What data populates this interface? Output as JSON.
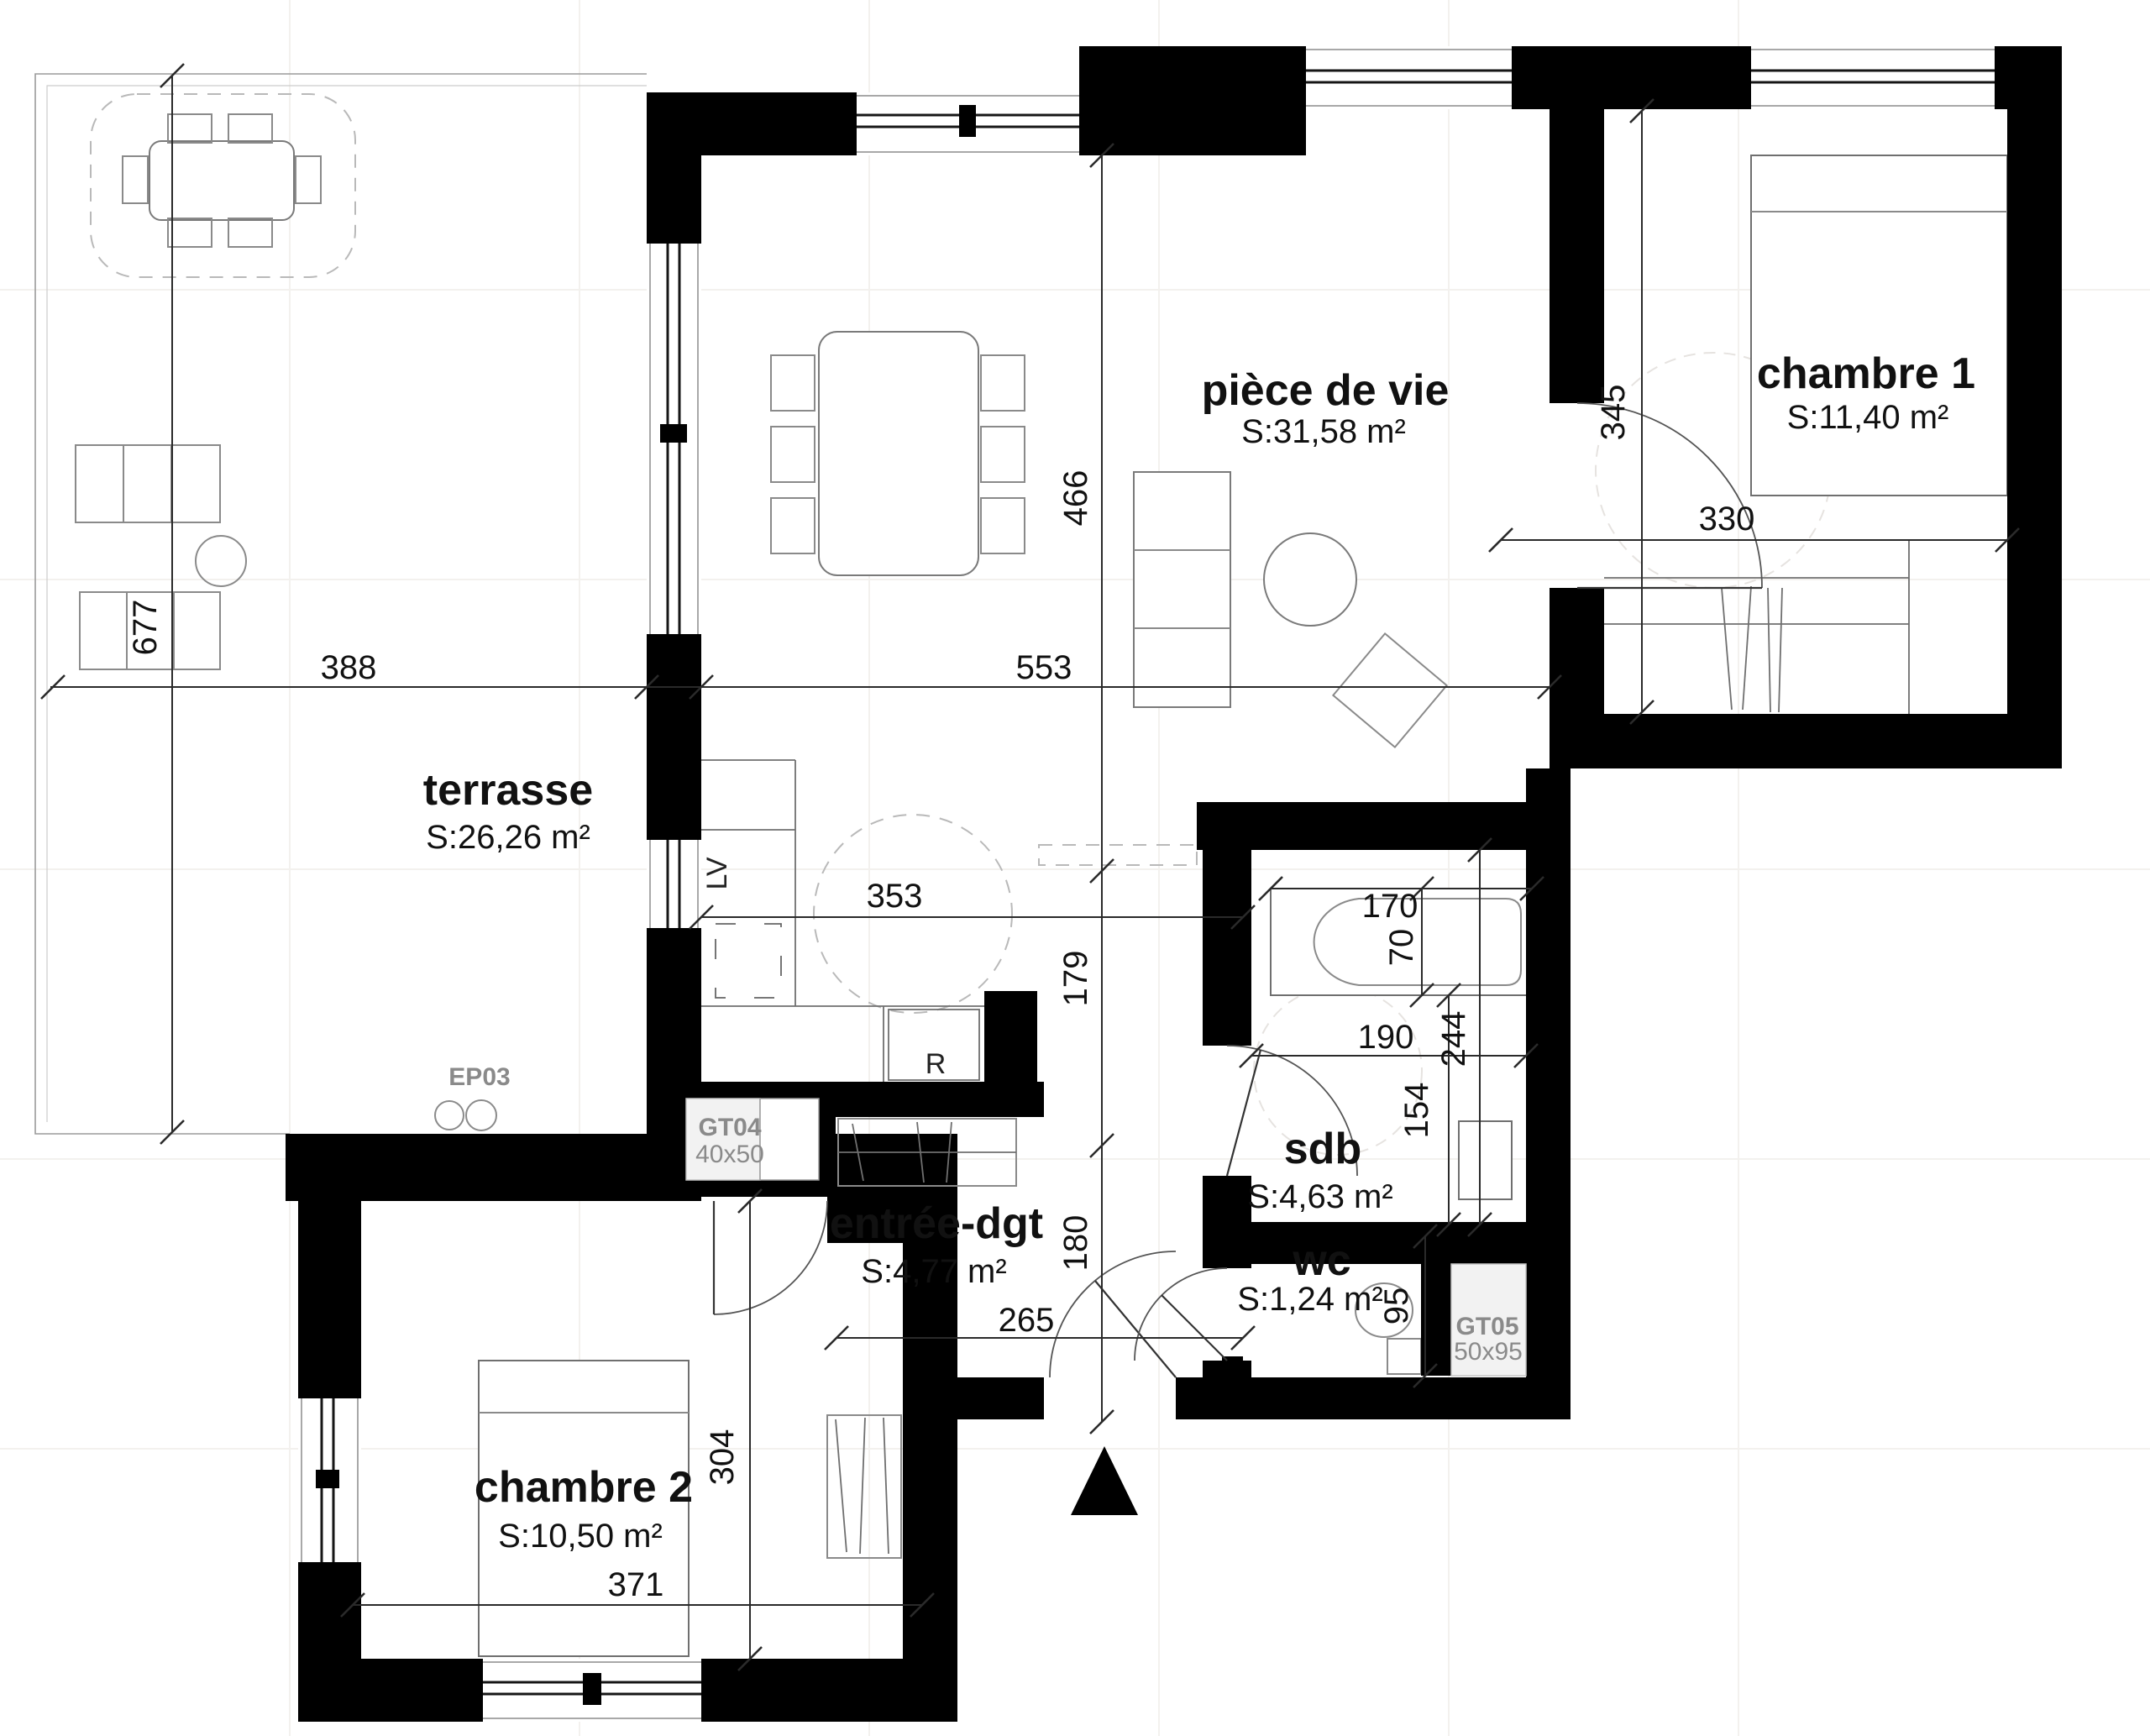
{
  "plan": {
    "background": "#ffffff",
    "colors": {
      "wall": "#000000",
      "dimension_line": "#2a2a2a",
      "text": "#111111",
      "annotation_gray": "#8a8a8a",
      "technical_fill": "#f2f2f2",
      "fixture_line": "#777777"
    },
    "rooms": {
      "terrasse": {
        "name": "terrasse",
        "area": "S:26,26 m²"
      },
      "piece_de_vie": {
        "name": "pièce de vie",
        "area": "S:31,58 m²"
      },
      "chambre1": {
        "name": "chambre 1",
        "area": "S:11,40 m²"
      },
      "chambre2": {
        "name": "chambre 2",
        "area": "S:10,50 m²"
      },
      "entree": {
        "name": "entrée-dgt",
        "area": "S:4,77 m²"
      },
      "sdb": {
        "name": "sdb",
        "area": "S:4,63 m²"
      },
      "wc": {
        "name": "wc",
        "area": "S:1,24 m²"
      }
    },
    "dimensions_cm": {
      "terrasse_height": "677",
      "terrasse_width": "388",
      "living_width": "553",
      "living_height": "466",
      "chambre1_height": "345",
      "chambre1_width": "330",
      "kitchen_width": "353",
      "passage_height": "179",
      "entree_height": "180",
      "entree_width": "265",
      "bath_length": "170",
      "bath_width": "70",
      "sdb_width": "190",
      "sdb_height": "244",
      "sdb_right_height": "154",
      "wc_height": "95",
      "chambre2_height": "304",
      "chambre2_width": "371"
    },
    "annotations": {
      "ep03": "EP03",
      "gt04": "GT04",
      "gt04_size": "40x50",
      "gt05": "GT05",
      "gt05_size": "50x95",
      "dishwasher": "LV",
      "fridge": "R"
    }
  }
}
